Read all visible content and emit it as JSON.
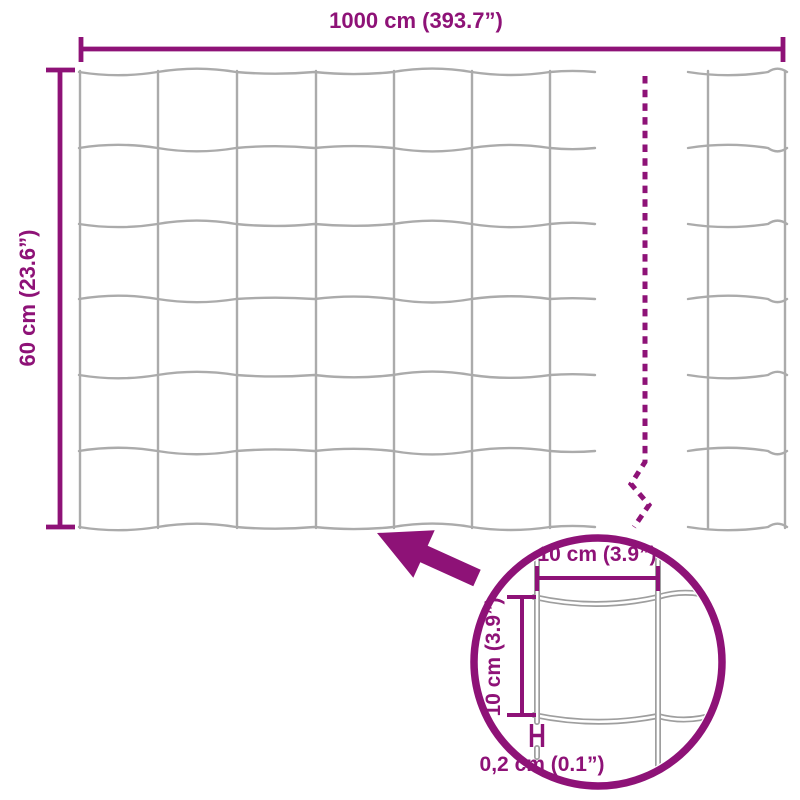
{
  "colors": {
    "accent": "#8e1277",
    "wire": "#ababab",
    "wire_detail": "#9e9e9e",
    "background": "#ffffff"
  },
  "fence": {
    "width_label": "1000 cm (393.7”)",
    "height_label": "60 cm (23.6”)"
  },
  "detail": {
    "mesh_width_label": "10 cm (3.9”)",
    "mesh_height_label": "10 cm (3.9”)",
    "wire_thickness_label": "0,2 cm (0.1”)"
  }
}
